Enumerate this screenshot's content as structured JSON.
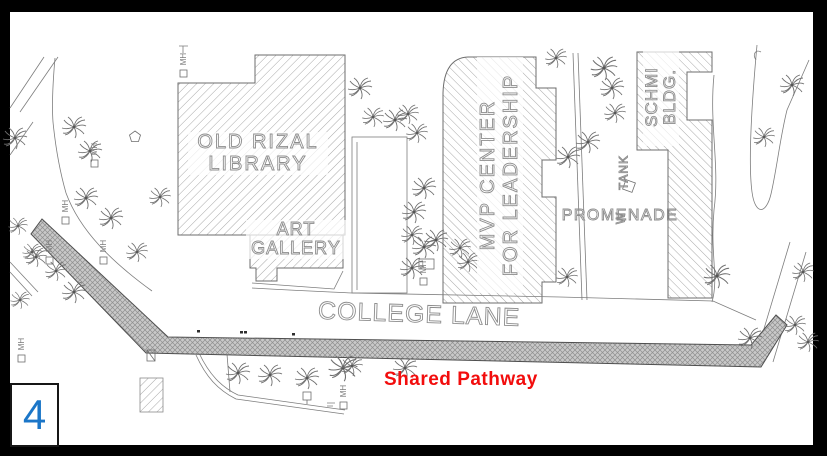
{
  "page": {
    "number": "4"
  },
  "colors": {
    "frame": "#000000",
    "paper": "#ffffff",
    "drawing_line": "#7d7d7d",
    "hatch_line": "#a8a8a8",
    "cad_text_outline": "#8d8d8d",
    "pathway_fill": "#c9c9c9",
    "pathway_texture": "#909090",
    "shared_pathway_text": "#f20d0d",
    "page_number_text": "#1b76c8"
  },
  "labels": {
    "library_line1": "OLD RIZAL",
    "library_line2": "LIBRARY",
    "gallery_line1": "ART",
    "gallery_line2": "GALLERY",
    "mvp_line1": "MVP CENTER",
    "mvp_line2": "FOR LEADERSHIP",
    "schmi_line1": "SCHMI",
    "schmi_line2": "BLDG.",
    "promenade": "PROMENADE",
    "tank": "TANK",
    "tank_w": "W",
    "college_lane": "COLLEGE LANE",
    "shared_pathway": "Shared Pathway",
    "manhole": "MH"
  }
}
